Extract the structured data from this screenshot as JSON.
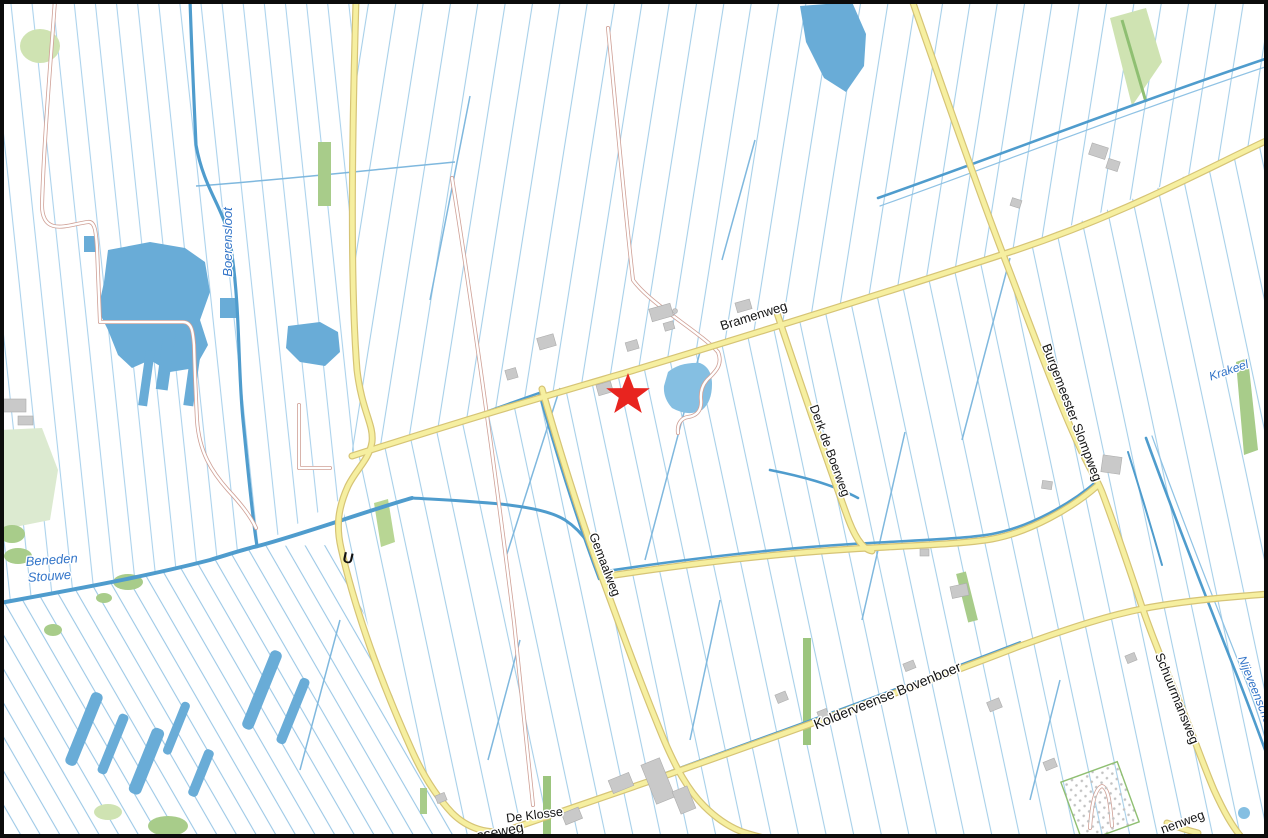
{
  "map": {
    "type": "topographic-map",
    "marker": {
      "kind": "star",
      "color": "#e8241f",
      "x": 628,
      "y": 395
    },
    "road_labels": [
      {
        "id": "bramenweg",
        "text": "Bramenweg",
        "x": 755,
        "y": 320,
        "rotate": -17.5
      },
      {
        "id": "derk-de-boerweg",
        "text": "Derk de Boerweg",
        "x": 826,
        "y": 452,
        "rotate": 70
      },
      {
        "id": "burgemeester-slompweg",
        "text": "Burgemeester Slompweg",
        "x": 1068,
        "y": 414,
        "rotate": 69
      },
      {
        "id": "gemaalweg",
        "text": "Gemaalweg",
        "x": 601,
        "y": 566,
        "rotate": 69
      },
      {
        "id": "schuurmansweg",
        "text": "Schuurmansweg",
        "x": 1173,
        "y": 700,
        "rotate": 68
      },
      {
        "id": "kolderveense-bovenboer",
        "text": "Kolderveense Bovenboer",
        "x": 889,
        "y": 700,
        "rotate": -22
      },
      {
        "id": "de-klosse",
        "text": "De Klosse",
        "x": 535,
        "y": 819,
        "rotate": -7
      },
      {
        "id": "sseweg-fragment",
        "text": "sseweg",
        "x": 501,
        "y": 836,
        "rotate": -11
      },
      {
        "id": "nenweg-fragment",
        "text": "nenweg",
        "x": 1184,
        "y": 826,
        "rotate": -20
      },
      {
        "id": "bridge-symbol",
        "text": "U",
        "x": 347,
        "y": 563,
        "rotate": 12
      }
    ],
    "water_labels": [
      {
        "id": "boerensloot",
        "text": "Boerensloot",
        "x": 232,
        "y": 242,
        "rotate": -90
      },
      {
        "id": "beneden-stouwe",
        "line1": "Beneden",
        "line2": "Stouwe",
        "x": 26,
        "y": 566,
        "rotate": -4
      },
      {
        "id": "krakeel",
        "text": "Krakeel",
        "x": 1230,
        "y": 374,
        "rotate": -19
      },
      {
        "id": "nijeveensche",
        "text": "Nijeveensche Gr",
        "x": 1238,
        "y": 658,
        "rotate": 68
      }
    ],
    "colors": {
      "field_ditch": "#a6cfe9",
      "canal": "#4f9ccd",
      "water_fill": "#69acd7",
      "pond_fill": "#85bfe2",
      "road_fill": "#f6efa0",
      "road_casing": "#d6c476",
      "minor_road_casing": "#cfa096",
      "green_area": "#a8cc8a",
      "green_pale": "#cfe3b2",
      "building": "#c9c9c9",
      "marker_red": "#e8241f",
      "water_text": "#3274c8",
      "road_text": "#151515",
      "frame_border": "#0c0c0c"
    }
  }
}
